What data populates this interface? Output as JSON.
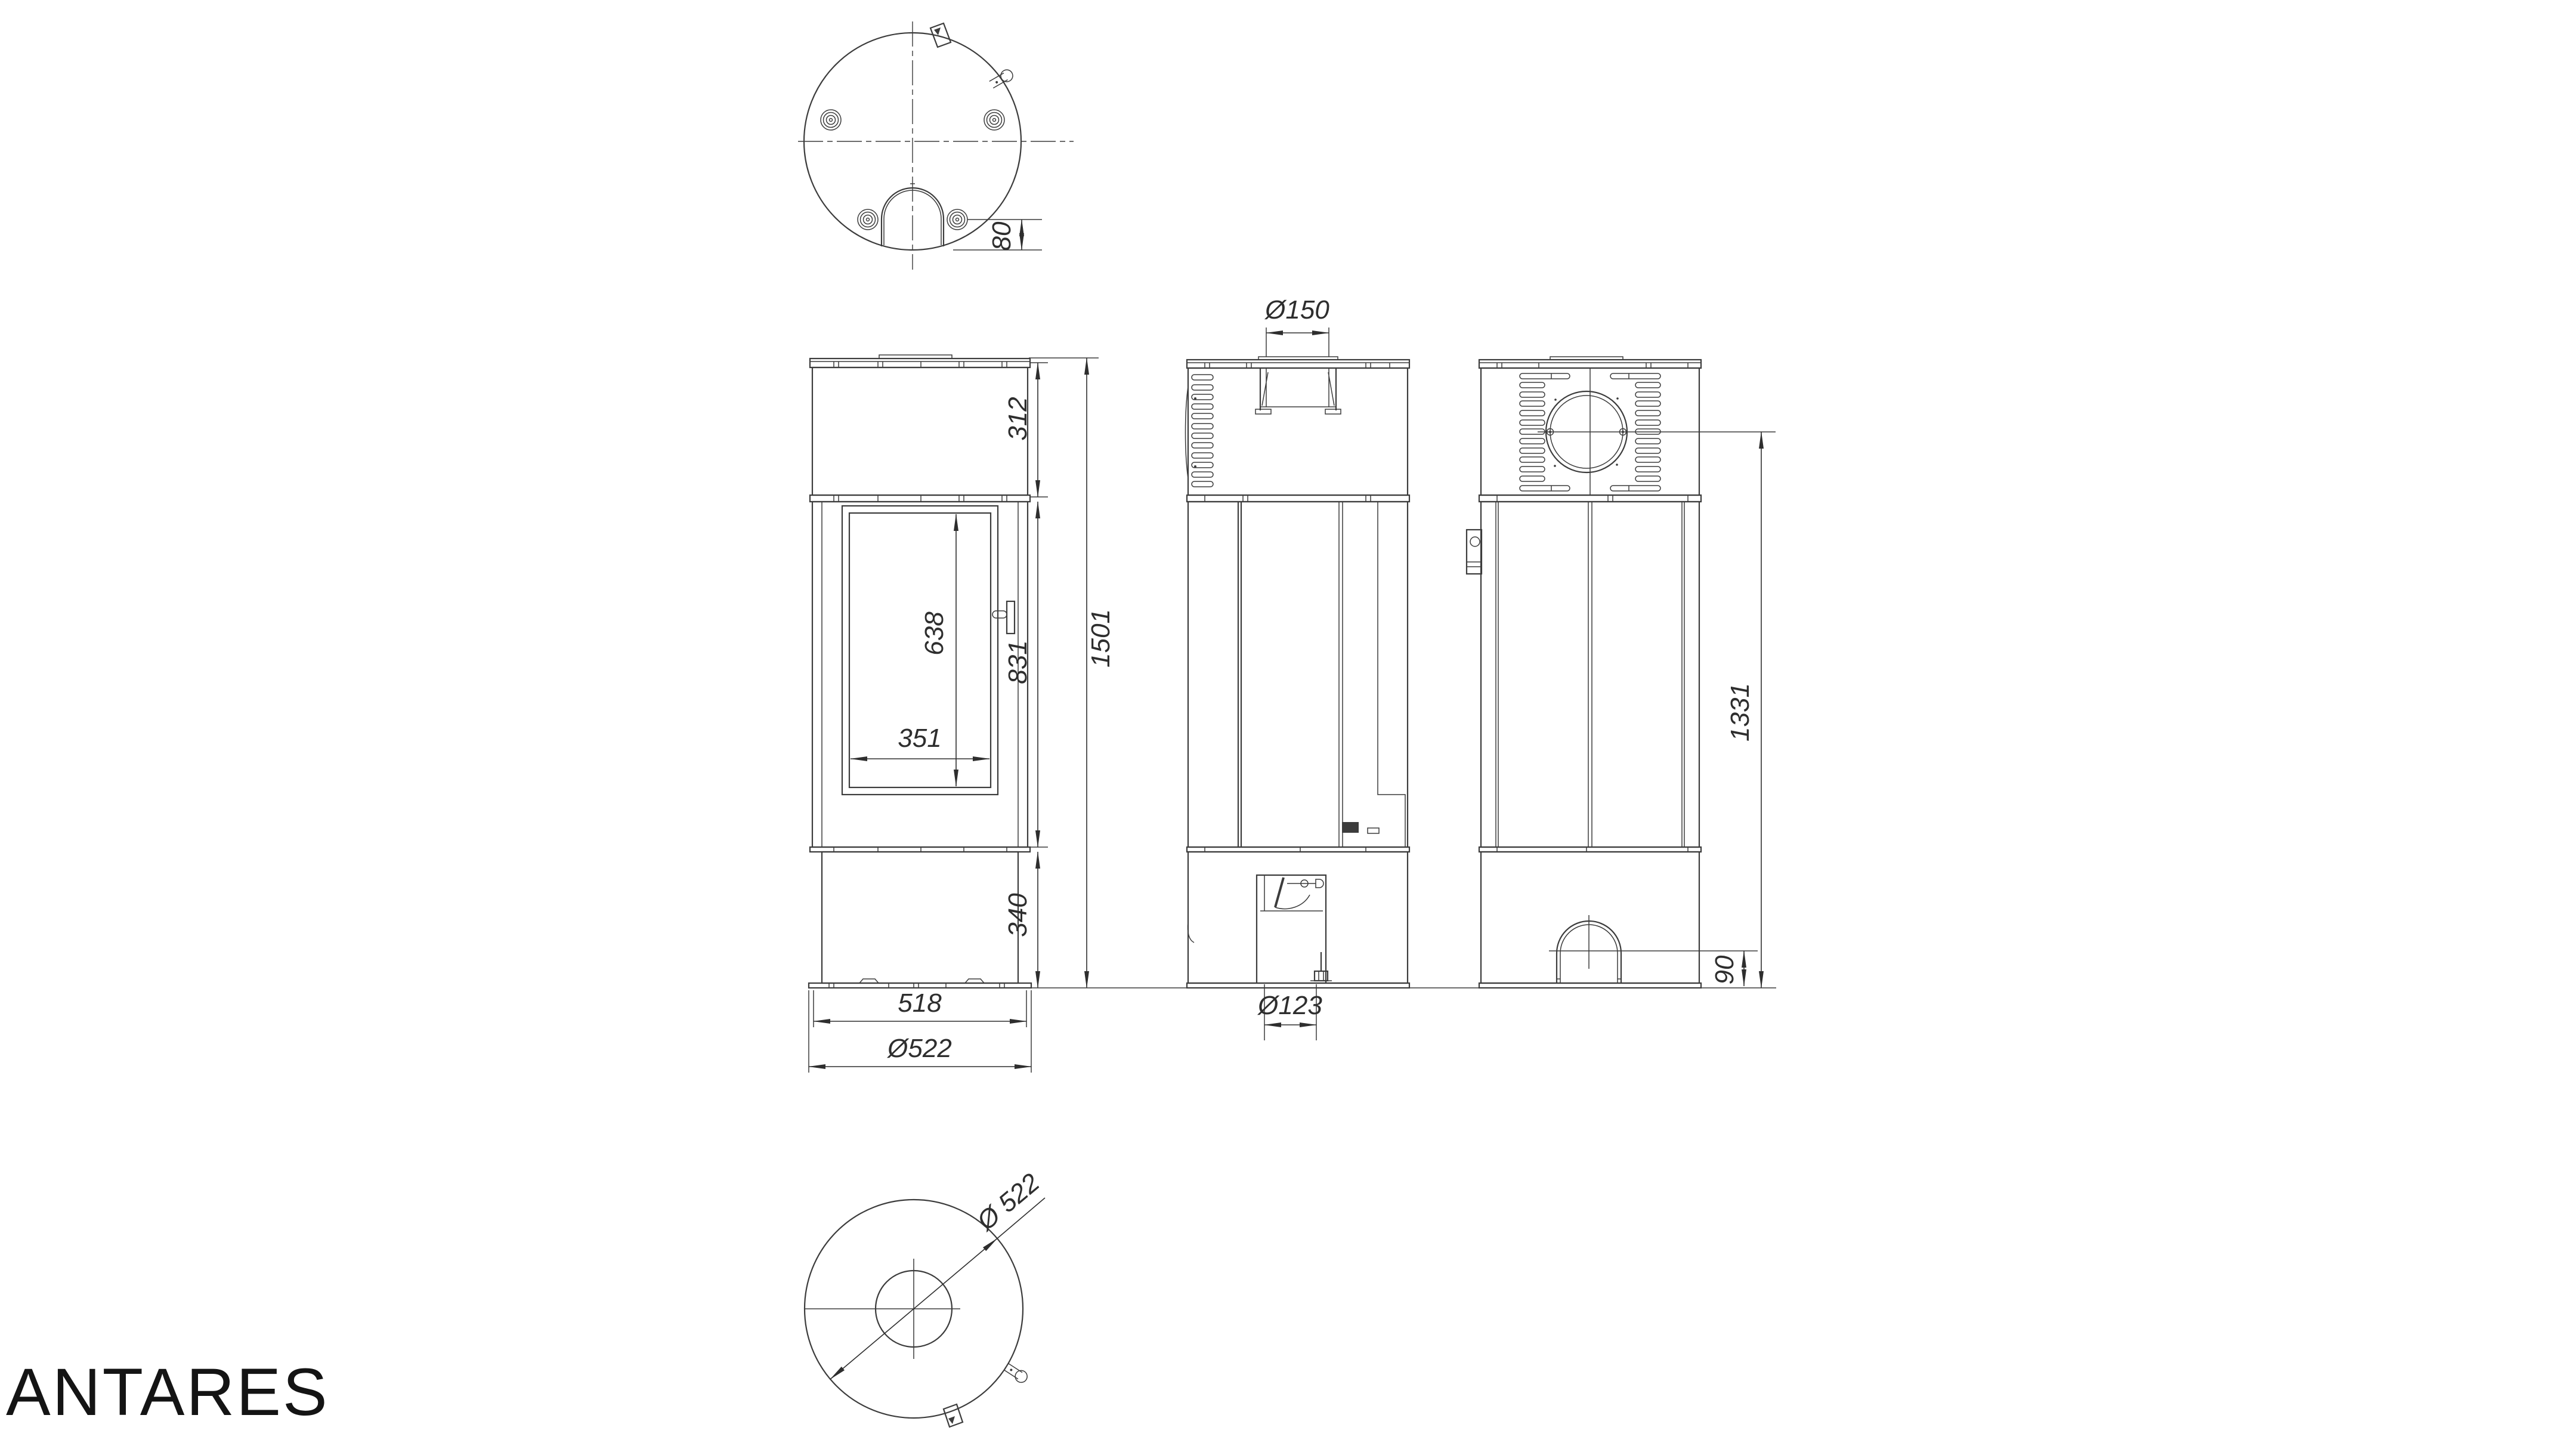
{
  "brand": "ANTARES",
  "dimensions": {
    "foot_to_front_offset": "80",
    "top_section_height": "312",
    "glass_height": "638",
    "glass_width": "351",
    "body_section_height": "831",
    "total_height": "1501",
    "base_height": "340",
    "body_width": "518",
    "plinth_diameter": "Ø522",
    "flue_collar_diameter": "Ø150",
    "air_intake_diameter": "Ø123",
    "flue_axis_height": "1331",
    "arch_axis_height": "90",
    "overall_diameter": "Ø 522"
  },
  "colors": {
    "line": "#3c3c3c",
    "text": "#2e2e2e",
    "background": "#ffffff"
  }
}
